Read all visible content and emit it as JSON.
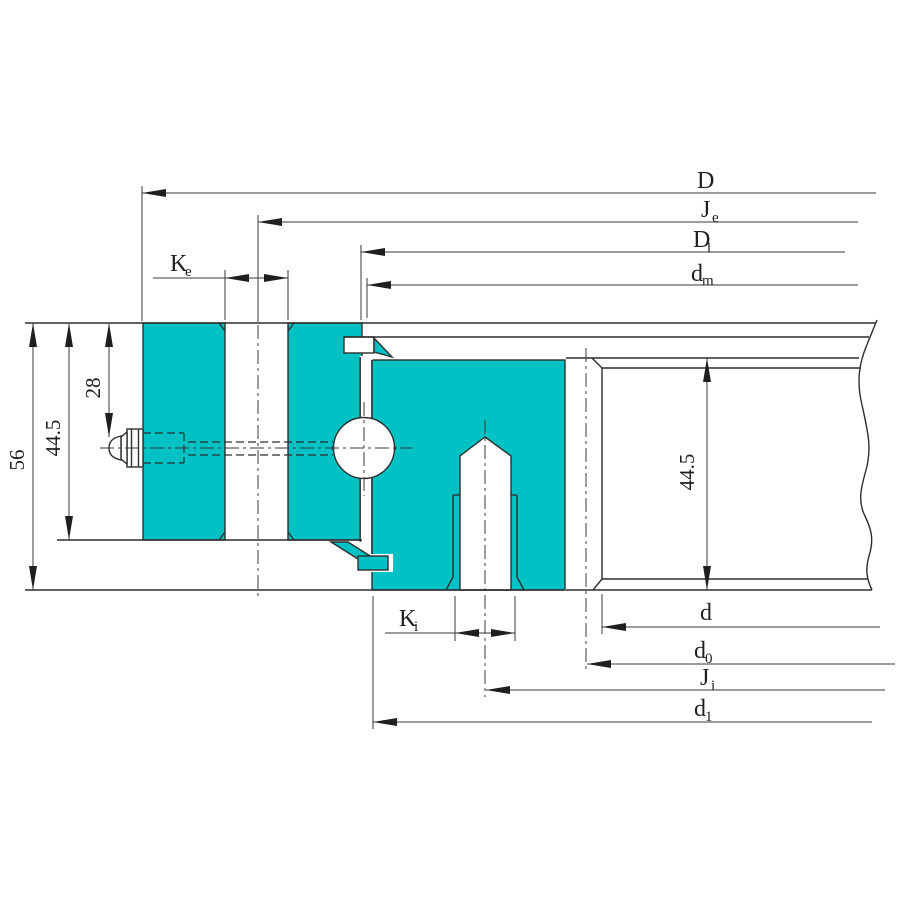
{
  "drawing": {
    "type": "slewing-bearing-cross-section",
    "colors": {
      "ring_fill": "#00c1c3",
      "line": "#2e2e2e",
      "dim_line": "#3a3a3a"
    },
    "dims": {
      "top": [
        {
          "name": "D",
          "main": "D",
          "sub": ""
        },
        {
          "name": "Je",
          "main": "J",
          "sub": "e"
        },
        {
          "name": "D1",
          "main": "D",
          "sub": "1"
        },
        {
          "name": "dm",
          "main": "d",
          "sub": "m"
        }
      ],
      "bottom": [
        {
          "name": "d",
          "main": "d",
          "sub": ""
        },
        {
          "name": "d0",
          "main": "d",
          "sub": "0"
        },
        {
          "name": "Ji",
          "main": "J",
          "sub": "i"
        },
        {
          "name": "d1",
          "main": "d",
          "sub": "1"
        }
      ],
      "left": [
        {
          "name": "height-56",
          "value": "56"
        },
        {
          "name": "height-44-5",
          "value": "44.5"
        },
        {
          "name": "height-28",
          "value": "28"
        }
      ],
      "right": [
        {
          "name": "height-44-5-right",
          "value": "44.5"
        }
      ],
      "holes": [
        {
          "name": "Ke",
          "main": "K",
          "sub": "e"
        },
        {
          "name": "Ki",
          "main": "K",
          "sub": "i"
        }
      ]
    }
  }
}
